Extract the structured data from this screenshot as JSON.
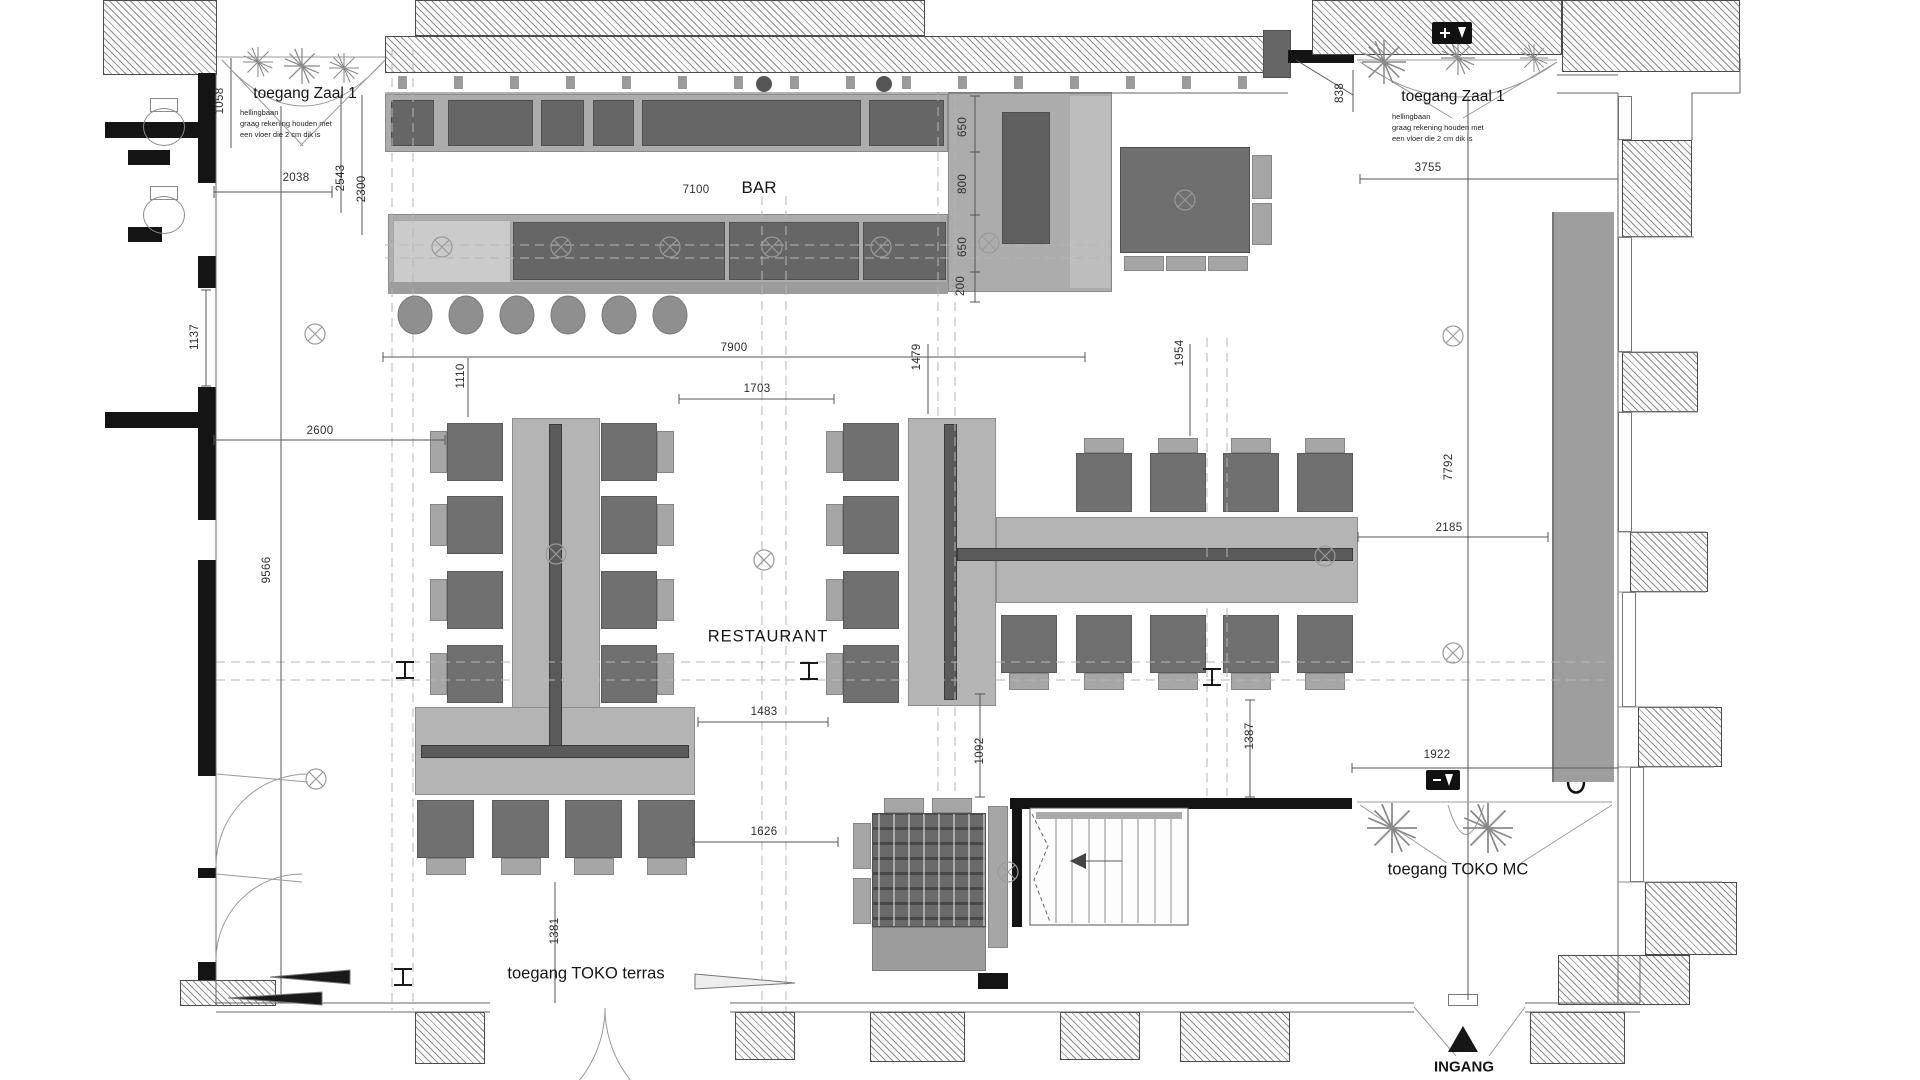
{
  "colors": {
    "wall": "#141414",
    "furniture_dark": "#707070",
    "furniture_light": "#b4b4b4",
    "line": "#555555",
    "text": "#161616"
  },
  "rooms": {
    "bar": "BAR",
    "restaurant": "RESTAURANT"
  },
  "entrances": {
    "zaal1_left": "toegang Zaal 1",
    "zaal1_right": "toegang Zaal 1",
    "toko_terras": "toegang TOKO terras",
    "toko_mc": "toegang TOKO MC",
    "ingang": "INGANG"
  },
  "ramp_note": {
    "l1": "hellingbaan",
    "l2": "graag rekening houden met",
    "l3": "een vloer die 2 cm dik is"
  },
  "dims": {
    "v1058": "1058",
    "v2038": "2038",
    "v2543": "2543",
    "v2300": "2300",
    "v7100": "7100",
    "v650a": "650",
    "v800": "800",
    "v650b": "650",
    "v200": "200",
    "v838": "838",
    "v3755": "3755",
    "v1137": "1137",
    "v2600": "2600",
    "v7900": "7900",
    "v1110": "1110",
    "v1703": "1703",
    "v1479": "1479",
    "v1954": "1954",
    "v9566": "9566",
    "v7792": "7792",
    "v2185": "2185",
    "v1483": "1483",
    "v1626": "1626",
    "v1092": "1092",
    "v1387": "1387",
    "v1922": "1922",
    "v1381": "1381"
  }
}
